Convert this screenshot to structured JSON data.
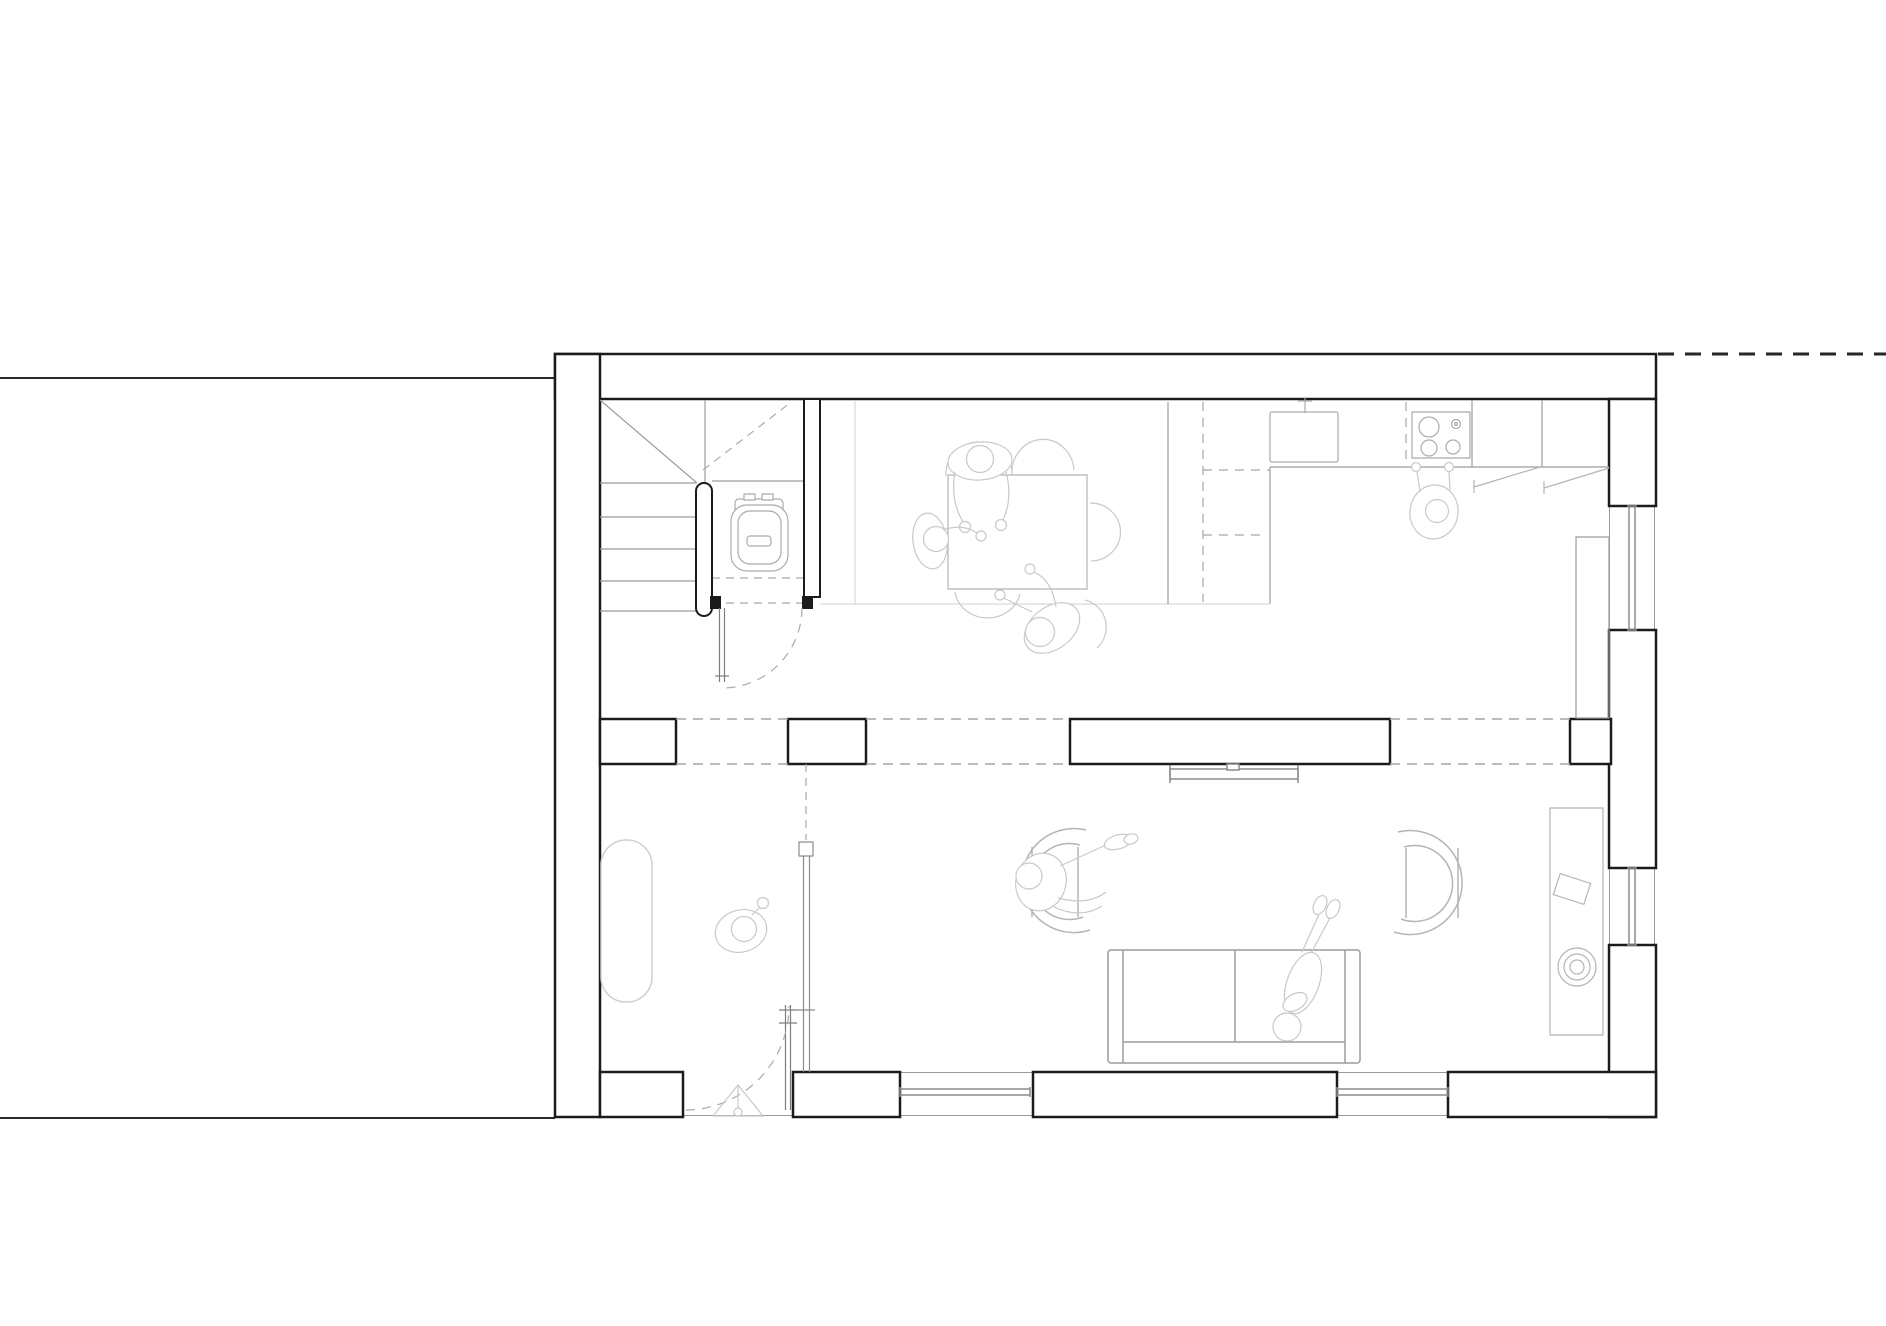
{
  "canvas": {
    "width": 1886,
    "height": 1326,
    "background": "#ffffff"
  },
  "colors": {
    "site_line": "#2a2a2a",
    "boundary_dash": "#262626",
    "wall": "#1b1b1b",
    "wall_face": "#9a9a9a",
    "window_glass": "#8c8c8c",
    "opening_dash": "#a6a6a6",
    "swing_dash": "#ababab",
    "door_leaf": "#7e7e7e",
    "stair": "#9c9c9c",
    "fixture": "#ababab",
    "furniture": "#b5b5b5",
    "furniture_light": "#c9c9c9",
    "figure": "#c9c9c9",
    "floor_line": "#d0d0d0"
  },
  "plan": {
    "drawing_type": "residential ground floor plan, top view, black linework on white",
    "rooms": [
      {
        "name": "hall-with-stair-and-wc"
      },
      {
        "name": "kitchen-dining"
      },
      {
        "name": "living-room"
      }
    ],
    "features": [
      {
        "name": "neighbor-party-walls"
      },
      {
        "name": "plot-boundary-dashed-line"
      },
      {
        "name": "exterior-walls-with-window-piers"
      },
      {
        "name": "internal-partition-wall-with-openings"
      },
      {
        "name": "winder-staircase"
      },
      {
        "name": "toilet-under-stair"
      },
      {
        "name": "wc-door-with-swing"
      },
      {
        "name": "entry-door-with-swing"
      },
      {
        "name": "entry-direction-triangle"
      },
      {
        "name": "glass-screen-partition"
      },
      {
        "name": "hall-bench"
      },
      {
        "name": "kitchen-counter-l-shape"
      },
      {
        "name": "kitchen-sink-with-faucet"
      },
      {
        "name": "cooktop-four-burners"
      },
      {
        "name": "dashed-upper-cabinets"
      },
      {
        "name": "tall-cabinet"
      },
      {
        "name": "cabinet-flap-symbols"
      },
      {
        "name": "dining-table"
      },
      {
        "name": "dining-chairs"
      },
      {
        "name": "wall-mounted-tv"
      },
      {
        "name": "sofa-two-seat"
      },
      {
        "name": "armchair-left"
      },
      {
        "name": "armchair-right"
      },
      {
        "name": "sideboard-with-bowl"
      },
      {
        "name": "windows-bottom-wall"
      },
      {
        "name": "windows-right-wall"
      }
    ],
    "people": [
      {
        "name": "person-dining-top"
      },
      {
        "name": "person-dining-left"
      },
      {
        "name": "person-dining-bottom"
      },
      {
        "name": "person-cooking"
      },
      {
        "name": "person-standing-hall"
      },
      {
        "name": "person-lounging-armchair"
      },
      {
        "name": "person-lying-sofa"
      }
    ]
  }
}
